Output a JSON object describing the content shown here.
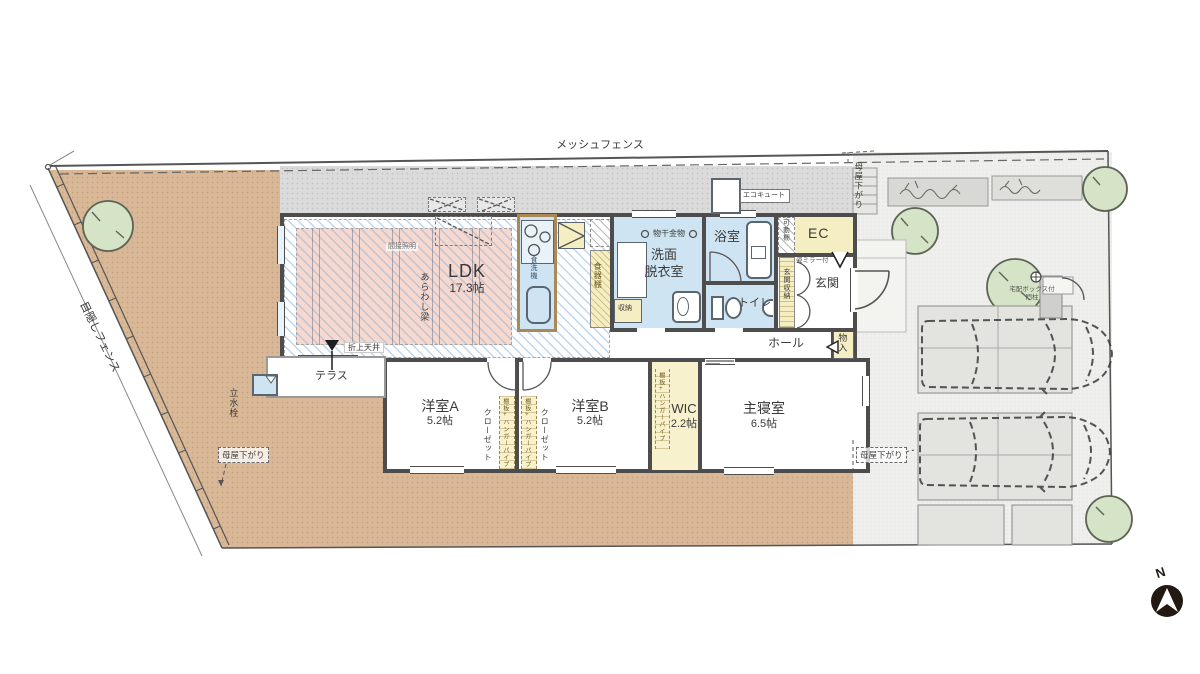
{
  "site": {
    "fence_top": "メッシュフェンス",
    "fence_left": "目隠しフェンス",
    "moyasagari": "母屋下がり",
    "compass_n": "N",
    "gate_line1": "宅配ボックス付",
    "gate_line2": "門柱",
    "tap": "立水栓",
    "terrace": "テラス",
    "ecocute": "エコキュート"
  },
  "rooms": {
    "ldk": {
      "name": "LDK",
      "size": "17.3帖"
    },
    "youshitsu_a": {
      "name": "洋室A",
      "size": "5.2帖"
    },
    "youshitsu_b": {
      "name": "洋室B",
      "size": "5.2帖"
    },
    "wic": {
      "name": "WIC",
      "size": "2.2帖"
    },
    "shushinshitsu": {
      "name": "主寝室",
      "size": "6.5帖"
    },
    "senmen_line1": "洗面",
    "senmen_line2": "脱衣室",
    "bath": "浴室",
    "toilet": "トイレ",
    "genkan": "玄関",
    "hall": "ホール",
    "ec": "EC"
  },
  "features": {
    "arawashi_hari": "あらわし梁",
    "oriage_tenjo": "折上天井",
    "kansetsu_shomei": "間接照明",
    "monohoshi_kanamono": "物干金物",
    "shokusenki": "食洗機",
    "shokkidana": "食器棚",
    "shuno": "収納",
    "monoire": "物入",
    "genkan_shuno": "玄関収納",
    "mirror": "姿ミラー付",
    "kadodana": "可動棚",
    "closet": "クローゼット",
    "hanger_pipe": "棚板+ハンガーパイプ"
  },
  "colors": {
    "ground_brown": "#d9b897",
    "concrete": "#dbdbdb",
    "room_blue": "#cfe4f2",
    "room_yellow": "#f6eec3",
    "ldk_pink": "#f6d8cf",
    "tree_green": "#d5e3c6",
    "wall": "#4d4d4d"
  }
}
